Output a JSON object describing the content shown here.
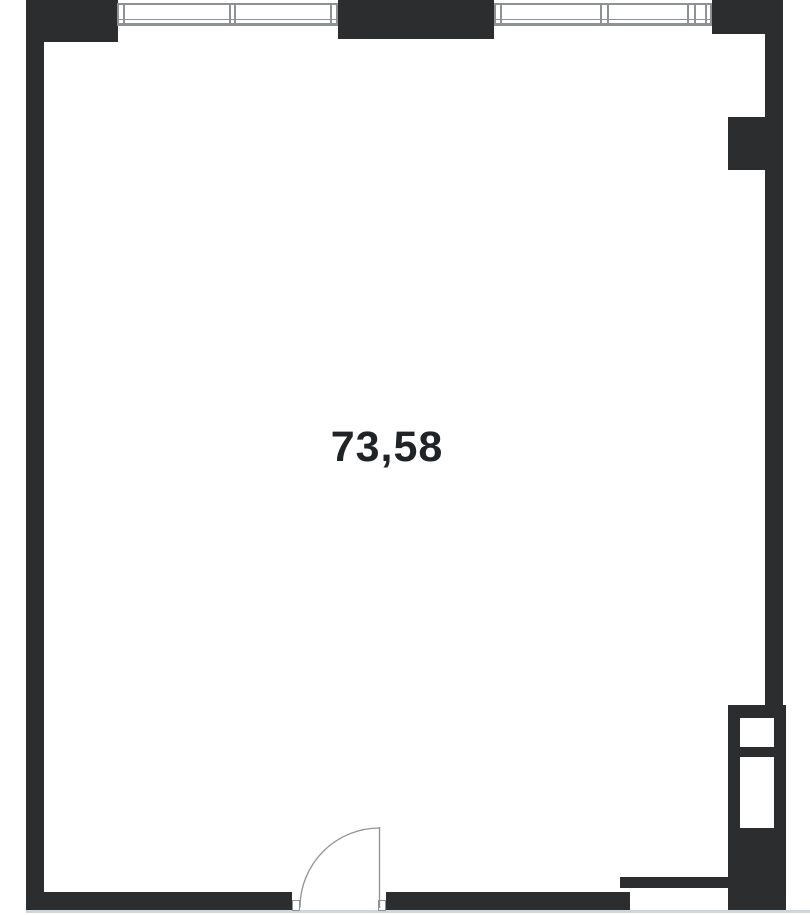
{
  "floor_plan": {
    "area_label": "73,58",
    "colors": {
      "wall": "#2b2d2e",
      "line": "#8d9295",
      "floor_edge": "#ccd6dc",
      "label": "#212426",
      "background": "#ffffff"
    }
  }
}
